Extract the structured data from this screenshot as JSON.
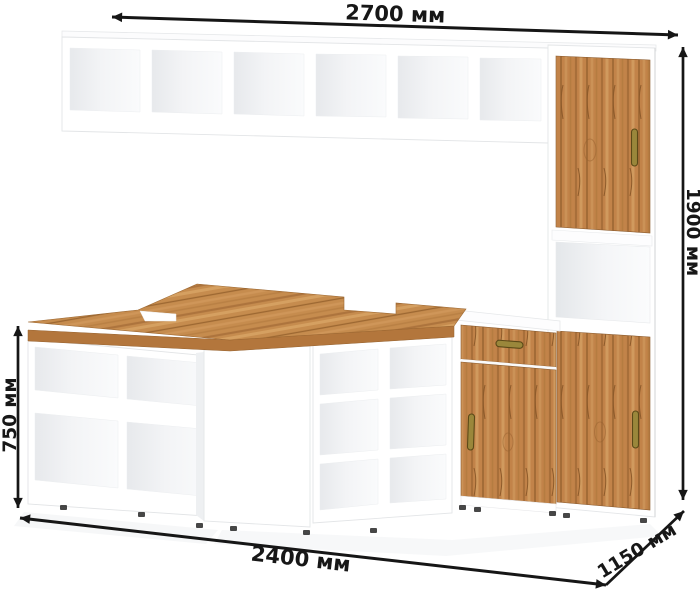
{
  "diagram": {
    "kind": "furniture-dimension-diagram",
    "dimensions": {
      "top_width": "2700 мм",
      "right_height": "1900 мм",
      "left_height": "750 мм",
      "bottom_width": "2400 мм",
      "depth": "1150 мм"
    },
    "colors": {
      "background": "#ffffff",
      "arrow": "#161616",
      "label_text": "#171717",
      "carcass_white": "#ffffff",
      "carcass_edge": "#e4e6e8",
      "cubby_shade": "#e9ebee",
      "wood": "#c28349",
      "wood_dark": "#96622f",
      "wood_light": "#d09a5e",
      "wood_edge": "#b3763c",
      "handle_brass": "#9a873b",
      "handle_brass_dark": "#5c4a18"
    }
  }
}
